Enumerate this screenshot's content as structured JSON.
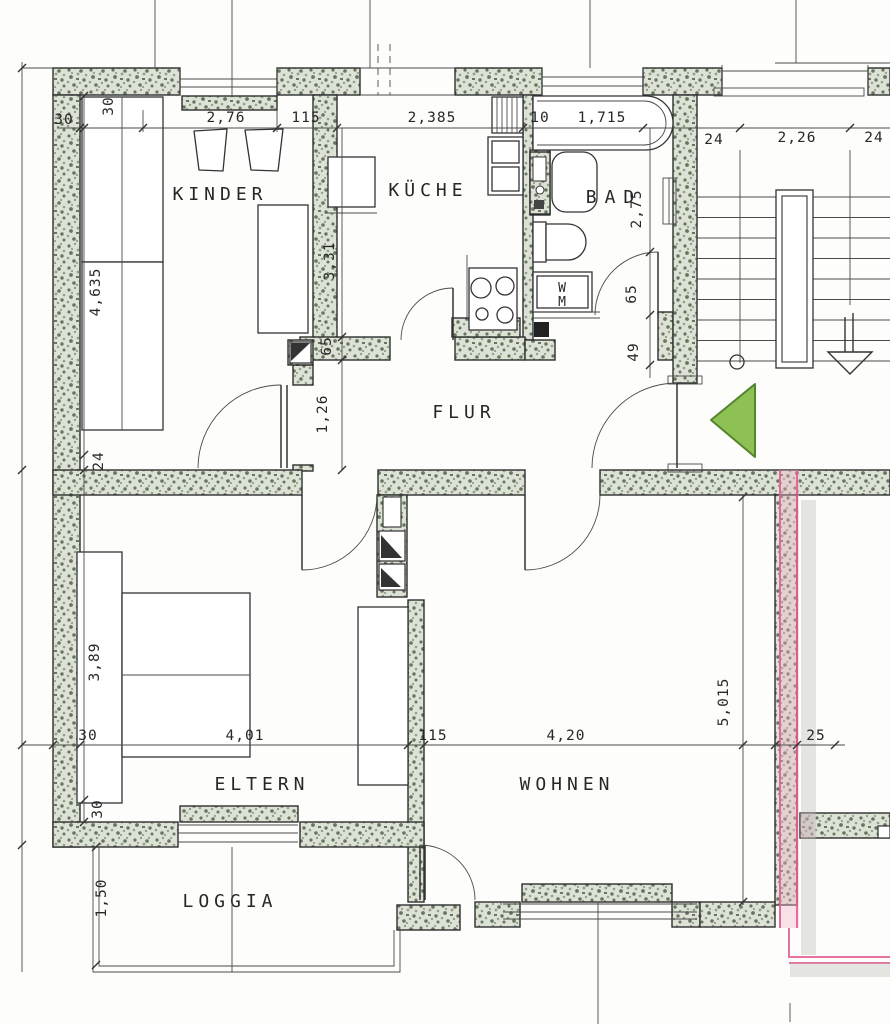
{
  "plan_type": "apartment floor plan",
  "rooms": {
    "kinder": "KINDER",
    "kueche": "KÜCHE",
    "bad": "BAD",
    "flur": "FLUR",
    "eltern": "ELTERN",
    "wohnen": "WOHNEN",
    "loggia": "LOGGIA",
    "wm_top": "W",
    "wm_bottom": "M"
  },
  "dims_top": {
    "wall_30": "30",
    "kinder_window": "2,76",
    "pier_115": "115",
    "kueche_window": "2,385",
    "wall_10": "10",
    "bad_window": "1,715"
  },
  "dims_stair": {
    "left_24": "24",
    "width_226": "2,26",
    "right_24": "24"
  },
  "dims_left": {
    "upper_30": "30",
    "kinder_depth": "4,635",
    "wall_24": "24",
    "eltern_depth": "3,89",
    "sill_30": "30",
    "loggia_depth": "1,50"
  },
  "dims_mid": {
    "kueche_depth": "3,31",
    "niche_65": "65",
    "flur_width": "1,26",
    "bad_depth": "2,75",
    "bad_door_65": "65",
    "bad_niche_49": "49",
    "wohnen_depth": "5,015"
  },
  "dims_bottom": {
    "wall_30": "30",
    "eltern_width": "4,01",
    "pier_115": "115",
    "wohnen_width": "4,20",
    "wall_25": "25"
  },
  "colors": {
    "paper": "#fdfdfb",
    "wall_base": "#dde2d6",
    "wall_speck_dark": "#68755f",
    "wall_speck_mid": "#93a089",
    "line": "#2f2f2f",
    "pink": "#e05a90",
    "pink_soft": "#f2afc9",
    "shadow_gray": "#b4b4b2",
    "arrow_green": "#8dc153",
    "arrow_green_border": "#55842e"
  }
}
